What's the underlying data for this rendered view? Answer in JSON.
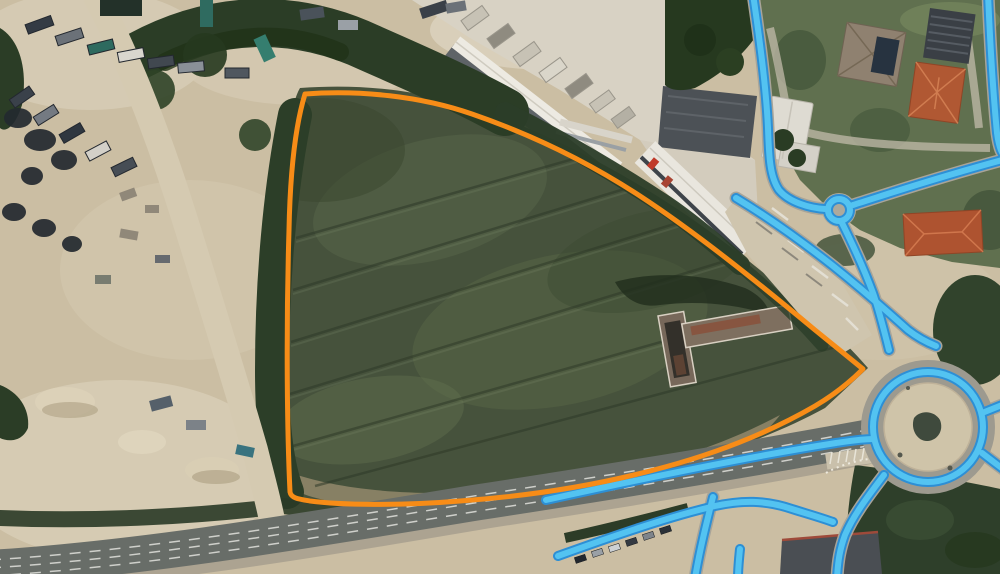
{
  "map": {
    "view": "satellite-aerial",
    "description": "aerial imagery with highlighted land parcel and traced road network",
    "overlays": {
      "parcel": {
        "label": "parcel-boundary",
        "color": "#F78C17",
        "stroke_width": 5,
        "path": "M 305,94 C 360,90 420,96 472,114 C 530,134 585,160 640,196 C 695,232 755,280 815,330 L 863,369 C 848,384 832,396 815,406 C 770,432 720,452 665,467 C 600,485 530,496 460,501 C 400,506 340,505 310,501 C 298,499 291,498 290,492 C 287,430 286,330 289,230 C 290,180 294,130 305,94 Z"
      },
      "roads": {
        "color": "#53C3F1",
        "casing_color": "#2D8FD5",
        "stroke_width": 6,
        "casing_width": 10,
        "paths": [
          {
            "id": "north-approach-road",
            "d": "M 753,-6 C 759,35 766,85 768,128 C 769,158 770,177 779,190 C 789,202 809,208 825,209"
          },
          {
            "id": "east-from-mini-roundabout",
            "d": "M 853,205 C 888,194 935,178 1006,159"
          },
          {
            "id": "right-edge-road",
            "d": "M 988,-6 C 990,40 993,92 997,133 C 999,148 1002,155 1007,158"
          },
          {
            "id": "mini-to-main-roundabout",
            "d": "M 841,221 C 851,241 863,266 873,293 C 879,310 884,330 889,350"
          },
          {
            "id": "diagonal-to-roundabout",
            "d": "M 736,198 C 766,216 800,240 833,266 C 863,290 888,312 908,330 C 917,337 926,342 936,346"
          },
          {
            "id": "highway-north-line",
            "d": "M 546,500 C 650,477 760,455 836,443 C 850,441 862,439 873,439"
          },
          {
            "id": "highway-south-line",
            "d": "M 558,556 C 622,533 672,516 715,506 C 742,500 765,500 792,509 C 808,514 822,518 833,522"
          },
          {
            "id": "roundabout-southwest-exit",
            "d": "M 884,475 C 869,495 854,514 845,535 C 840,549 838,560 837,578"
          },
          {
            "id": "south-crossing-road",
            "d": "M 713,497 C 706,525 700,549 695,578"
          },
          {
            "id": "south-stub",
            "d": "M 740,549 C 739,559 738,568 738,578"
          },
          {
            "id": "roundabout-east-exit-upper",
            "d": "M 982,413 L 1007,403"
          },
          {
            "id": "roundabout-east-exit-lower",
            "d": "M 982,453 C 991,460 999,466 1007,472"
          }
        ],
        "circles": [
          {
            "id": "mini-roundabout-ring",
            "cx": 839,
            "cy": 210,
            "r": 11
          },
          {
            "id": "main-roundabout-ring",
            "cx": 928,
            "cy": 427,
            "r": 55
          }
        ]
      }
    }
  }
}
